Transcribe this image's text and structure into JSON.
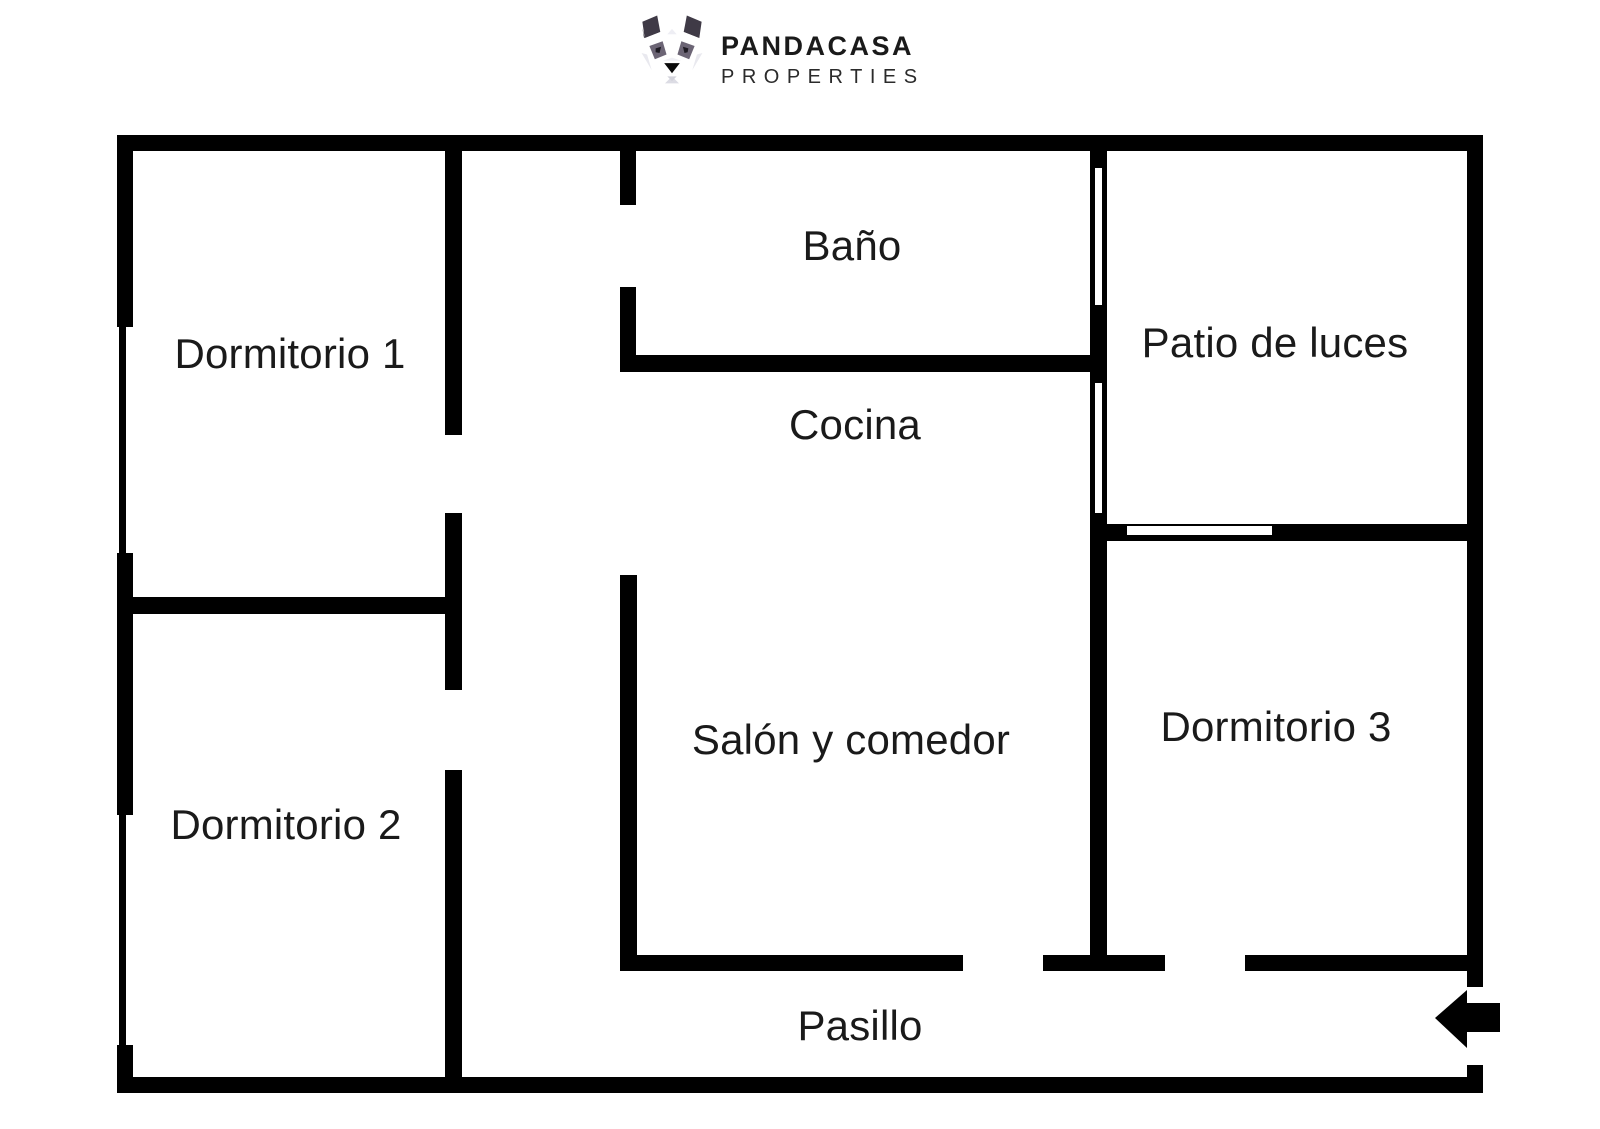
{
  "logo": {
    "brand": "PANDACASA",
    "tagline": "PROPERTIES",
    "icon": "panda-face-logo"
  },
  "rooms": [
    {
      "label": "Dormitorio 1"
    },
    {
      "label": "Baño"
    },
    {
      "label": "Patio de luces"
    },
    {
      "label": "Cocina"
    },
    {
      "label": "Dormitorio 2"
    },
    {
      "label": "Salón y comedor"
    },
    {
      "label": "Dormitorio 3"
    },
    {
      "label": "Pasillo"
    }
  ],
  "entrance": {
    "symbol": "arrow-left",
    "meaning": "entrance direction into Pasillo"
  },
  "colors": {
    "wall": "#000000",
    "background": "#ffffff",
    "text": "#1a1a1a",
    "panda_dark": "#3f3a46",
    "panda_patch": "#6c6575",
    "panda_facet": "#e9e9ef"
  }
}
